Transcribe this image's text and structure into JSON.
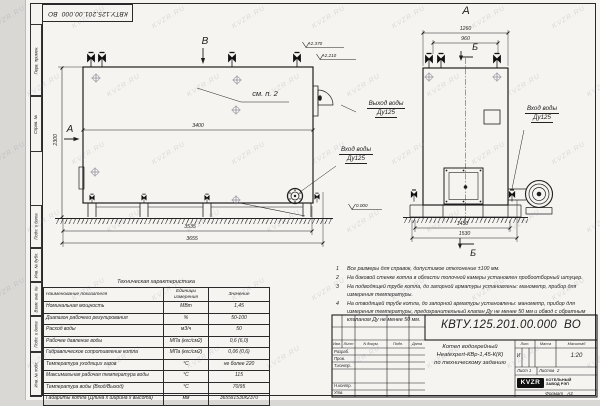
{
  "palette": {
    "paper": "#f5f4f1",
    "line": "#1f1f1f",
    "logo_bg": "#101010",
    "watermark": "#99a3af"
  },
  "watermark": {
    "text": "KVZR.RU"
  },
  "top_stamp": {
    "doc_number": "КВТУ.125.201.00.000  ВО"
  },
  "margin": {
    "labels": [
      "Перв. примен.",
      "Справ. №",
      "Подп. и дата",
      "Инв. № дубл.",
      "Взам. инв. №",
      "Подп. и дата",
      "Инв. № подл."
    ]
  },
  "drawing": {
    "side_view": {
      "letter_top": "В",
      "letter_left": "А",
      "callout": "см. п. 2",
      "dim_inner_width": "3400",
      "dim_height": "2300",
      "dim_base": "3535",
      "dim_total": "3655",
      "level_top": "+2.370",
      "level_mid": "+2.210",
      "level_zero": "0.000",
      "inlet_line1": "Вход воды",
      "inlet_line2": "Ду125"
    },
    "front_view": {
      "title": "А",
      "section_top": "Б",
      "section_bottom": "Б",
      "dim_top_outer": "1260",
      "dim_top_inner": "960",
      "dim_bottom_inner": "1430",
      "dim_bottom_outer": "1530",
      "outlet_line1": "Выход воды",
      "outlet_line2": "Ду125",
      "inlet_line1": "Вход воды",
      "inlet_line2": "Ду125"
    }
  },
  "notes": {
    "items": [
      {
        "num": "1",
        "text": "Все размеры для справок, допустимое отклонение ±100 мм."
      },
      {
        "num": "2",
        "text": "На боковой стенке котла в области топочной камеры установлен пробоотборный штуцер."
      },
      {
        "num": "3",
        "text": "На подводящей трубе котла, до запорной арматуры установлены: манометр, прибор для измерения температуры."
      },
      {
        "num": "4",
        "text": "На отводящей трубе котла, до запорной арматуры установлены: манометр, прибор для измерения температуры, предохранительный клапан Ду не менее 50 мм и обвод с обратным клапаном Ду не менее 50 мм."
      }
    ]
  },
  "spec_table": {
    "title": "Техническая характеристика",
    "col_name": "Наименование показателя",
    "col_units": "Единицы измерения",
    "col_value": "Значение",
    "rows": [
      {
        "name": "Номинальная мощность",
        "units": "МВт",
        "value": "1,45"
      },
      {
        "name": "Диапазон рабочего регулирования",
        "units": "%",
        "value": "50-100"
      },
      {
        "name": "Расход воды",
        "units": "м3/ч",
        "value": "50"
      },
      {
        "name": "Рабочее давление воды",
        "units": "МПа (кгс/см2)",
        "value": "0,6 (6,0)"
      },
      {
        "name": "Гидравлическое сопротивление котла",
        "units": "МПа (кгс/см2)",
        "value": "0,06 (0,6)"
      },
      {
        "name": "Температура уходящих газов",
        "units": "°С",
        "value": "не более 220"
      },
      {
        "name": "Максимальная рабочая температура воды",
        "units": "°С",
        "value": "115"
      },
      {
        "name": "Температура воды (Вход/Выход)",
        "units": "°С",
        "value": "70/95"
      },
      {
        "name": "Габариты котла (Длина х ширина х высота)",
        "units": "мм",
        "value": "3655х1530х2370"
      }
    ]
  },
  "title_block": {
    "doc_number": "КВТУ.125.201.00.000  ВО",
    "name_line1": "Котел водогрейный",
    "name_line2": "Heatexpert-КВр-1,45-К(К)",
    "name_line3": "по техническому заданию",
    "col_izm": "Изм.",
    "col_list": "Лист",
    "col_docum": "N докум.",
    "col_podp": "Подп.",
    "col_data": "Дата",
    "row_razrab": "Разраб.",
    "row_prov": "Пров.",
    "row_tkontr": "Т.контр.",
    "row_nkontr": "Н.контр.",
    "row_utv": "Утв.",
    "lit_label": "Лит.",
    "lit_value": "И",
    "massa_label": "Масса",
    "masshtab_label": "Масштаб",
    "scale": "1:20",
    "sheet_label": "Лист",
    "sheet_value": "1",
    "sheets_label": "Листов",
    "sheets_value": "2",
    "logo_text": "KVZR",
    "company_line1": "КОТЕЛЬНЫЙ",
    "company_line2": "ЗАВОД РЭП",
    "format_label": "Формат",
    "format_value": "А3"
  }
}
